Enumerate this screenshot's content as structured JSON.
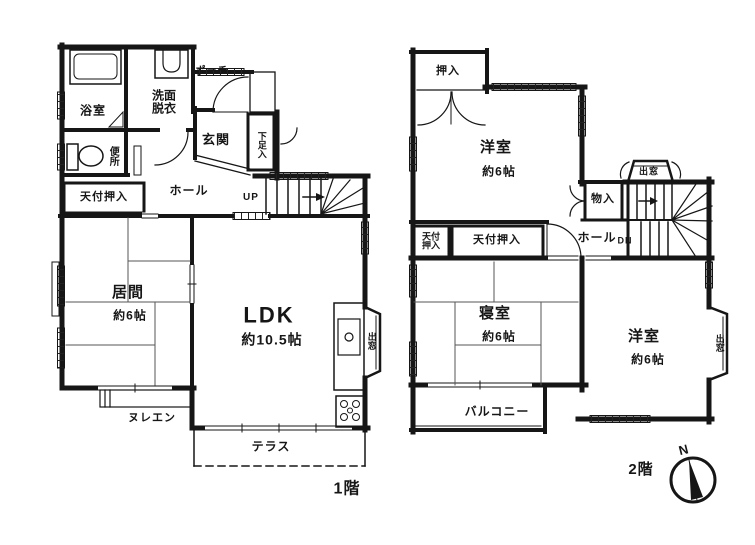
{
  "colors": {
    "ink": "#161616",
    "paper": "#ffffff"
  },
  "floor1": {
    "title": "1階",
    "labels": {
      "porch": "ポーチ",
      "bath": "浴室",
      "washroom": "洗面脱衣",
      "toilet": "便所",
      "entrance": "玄関",
      "shoe_cabinet": "下足入",
      "ceiling_closet": "天付押入",
      "hall": "ホール",
      "stairs_up": "UP",
      "living": "居間",
      "living_size": "約6帖",
      "ldk": "LDK",
      "ldk_size": "約10.5帖",
      "bay_window": "出窓",
      "open_veranda": "ヌレエン",
      "terrace": "テラス"
    }
  },
  "floor2": {
    "title": "2階",
    "labels": {
      "closet": "押入",
      "west_room_north": "洋室",
      "west_room_north_size": "約6帖",
      "bay_window_top": "出窓",
      "storage": "物入",
      "hall": "ホール",
      "stairs_down": "DN",
      "ceiling_closet_small": "天付押入",
      "ceiling_closet_wide": "天付押入",
      "bedroom": "寝室",
      "bedroom_size": "約6帖",
      "west_room_south": "洋室",
      "west_room_south_size": "約6帖",
      "bay_window_right": "出窓",
      "balcony": "バルコニー"
    }
  },
  "compass": {
    "north": "N"
  }
}
